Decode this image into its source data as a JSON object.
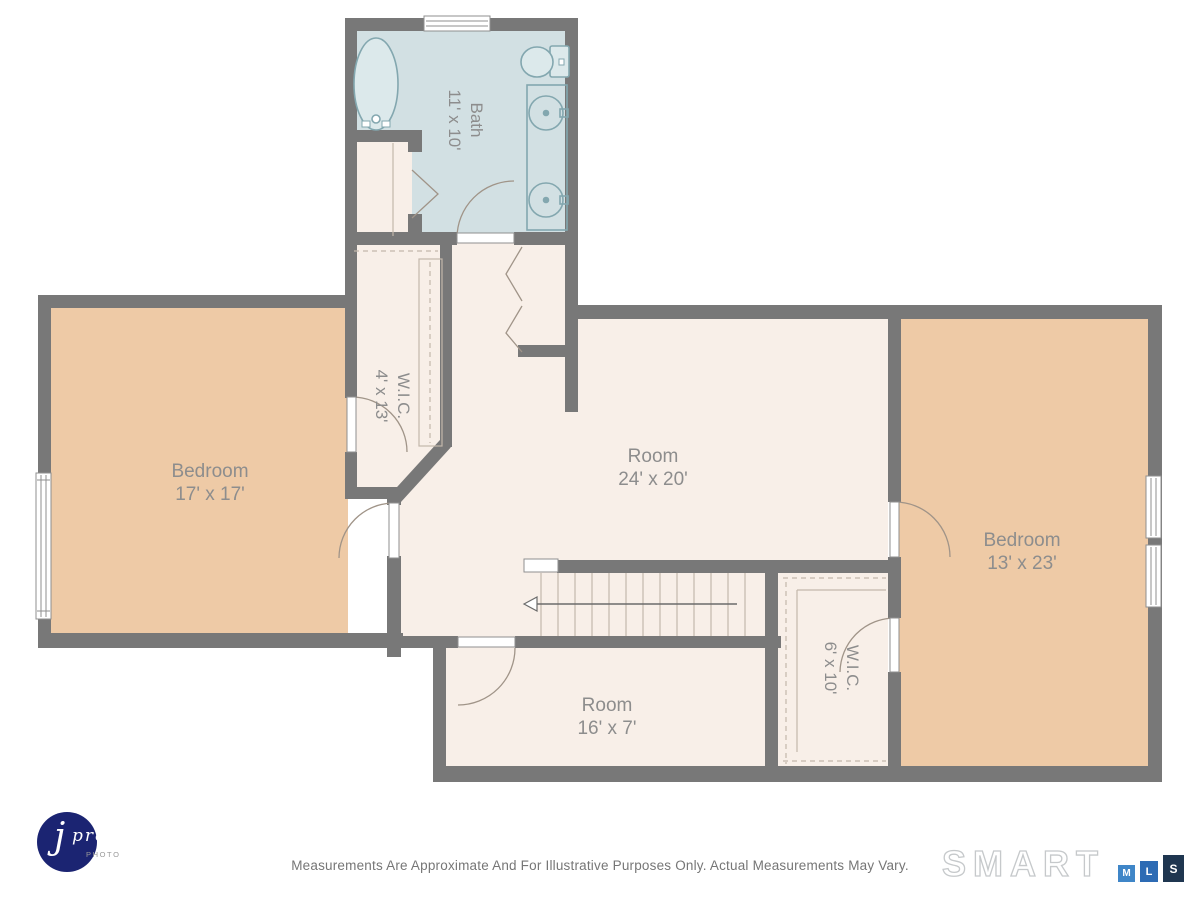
{
  "rooms": [
    {
      "name": "Bath",
      "dims": "11' x 10'"
    },
    {
      "name": "W.I.C.",
      "dims": "4' x 13'"
    },
    {
      "name": "Bedroom",
      "dims": "17' x 17'"
    },
    {
      "name": "Room",
      "dims": "24' x 20'"
    },
    {
      "name": "Bedroom",
      "dims": "13' x 23'"
    },
    {
      "name": "Room",
      "dims": "16' x 7'"
    },
    {
      "name": "W.I.C.",
      "dims": "6' x 10'"
    }
  ],
  "footer": {
    "disclaimer": "Measurements Are Approximate And For Illustrative Purposes Only. Actual Measurements May Vary."
  },
  "branding": {
    "photographer": {
      "initial": "j",
      "name": "pro",
      "sub": "PHOTO"
    },
    "mls": {
      "wordmark": "SMART",
      "letters": [
        "M",
        "L",
        "S"
      ]
    }
  },
  "colors": {
    "wall": "#787878",
    "bath_fill": "#d2e0e3",
    "room_fill": "#f8efe8",
    "bedroom_fill": "#eecaa6",
    "fixture_stroke": "#83a7af",
    "door_stroke": "#a09488",
    "closet_line": "#c3b7ab",
    "label": "#8d8d8d",
    "logo_navy": "#1b2472",
    "mls_m_blue": "#3f86c8",
    "mls_l_blue": "#2d6bb4",
    "mls_s_navy": "#1f3650",
    "smart_gray": "#c6c9cb"
  }
}
